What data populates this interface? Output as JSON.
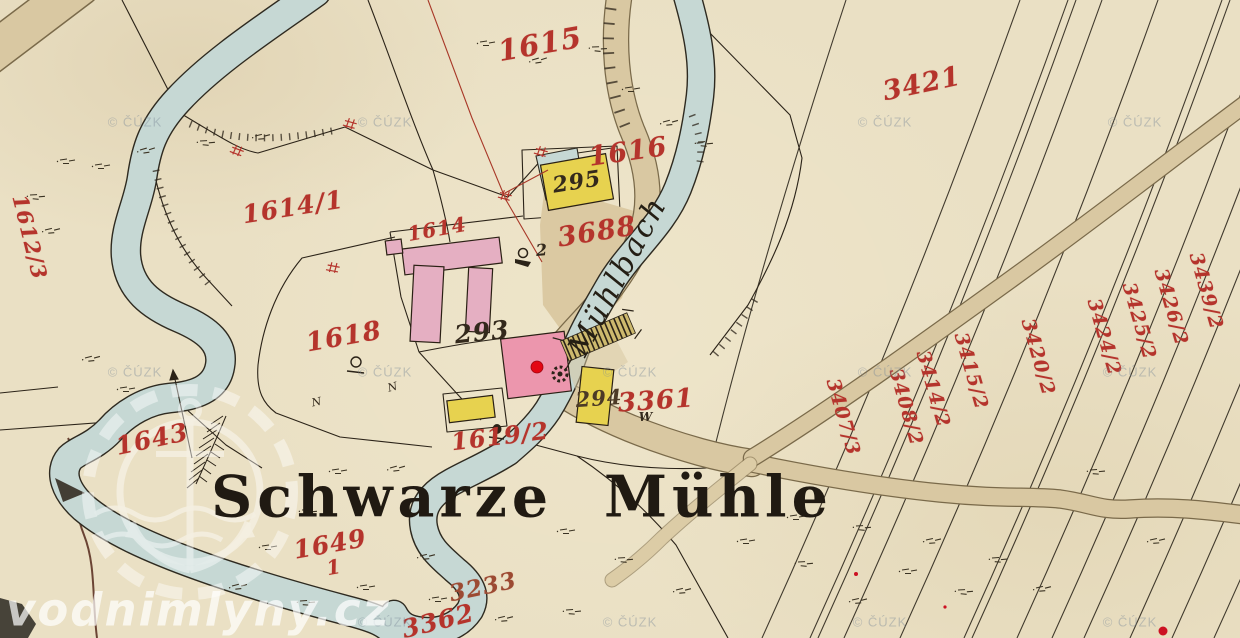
{
  "map_title": "Schwarze Mühle",
  "stream_label": "Mühlbach",
  "watermarks": {
    "source": "vodnimlyny.cz",
    "copyright": "© ČÚZK"
  },
  "colors": {
    "paper": "#eae0c4",
    "water": "#c6d8d4",
    "road": "#d9c8a2",
    "building_yellow": "#e7d24f",
    "building_pink": "#e5afc2",
    "building_mill": "#ec96ad",
    "parcel_number_red": "#b5342c",
    "ink": "#2b2318",
    "marker_red": "#e30613"
  },
  "symbols": {
    "house_number": "2",
    "weir_mark": "W",
    "tree_mark": "N"
  },
  "labels": [
    {
      "text": "1615"
    },
    {
      "text": "3421"
    },
    {
      "text": "1616"
    },
    {
      "text": "1614/1"
    },
    {
      "text": "1612/3"
    },
    {
      "text": "1614"
    },
    {
      "text": "3688"
    },
    {
      "text": "1618"
    },
    {
      "text": "293"
    },
    {
      "text": "295"
    },
    {
      "text": "294"
    },
    {
      "text": "3361"
    },
    {
      "text": "1619/2"
    },
    {
      "text": "1643"
    },
    {
      "text": "1649"
    },
    {
      "text": "1"
    },
    {
      "text": "3233"
    },
    {
      "text": "3362"
    },
    {
      "text": "3407/3"
    },
    {
      "text": "3408/2"
    },
    {
      "text": "3414/2"
    },
    {
      "text": "3415/2"
    },
    {
      "text": "3420/2"
    },
    {
      "text": "3424/2"
    },
    {
      "text": "3425/2"
    },
    {
      "text": "3426/2"
    },
    {
      "text": "3439/2"
    }
  ]
}
